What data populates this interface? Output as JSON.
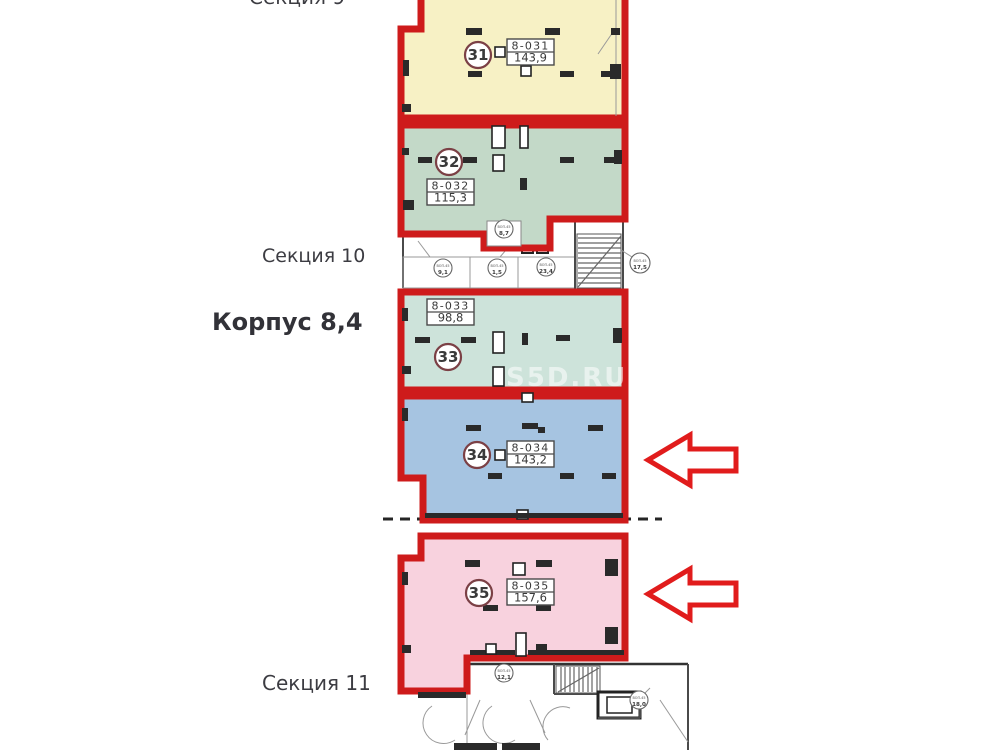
{
  "page": {
    "watermark": "S5D.RU"
  },
  "area_labels": {
    "section_9": "Секция 9",
    "section_10": "Секция 10",
    "building": "Корпус 8,4",
    "section_11": "Секция 11"
  },
  "colors": {
    "outline_red": "#ce1b1b",
    "arrow_red": "#e11c1c",
    "wall_dark": "#2a2a2a",
    "badge_border": "#7b4045"
  },
  "units": [
    {
      "number": "31",
      "code": "8-031",
      "area": "143,9",
      "fill": "#f7f1c5"
    },
    {
      "number": "32",
      "code": "8-032",
      "area": "115,3",
      "fill": "#c3d9c8"
    },
    {
      "number": "33",
      "code": "8-033",
      "area": "98,8",
      "fill": "#cde3da"
    },
    {
      "number": "34",
      "code": "8-034",
      "area": "143,2",
      "fill": "#a6c4e1"
    },
    {
      "number": "35",
      "code": "8-035",
      "area": "157,6",
      "fill": "#f8d2de"
    }
  ],
  "service_rooms": [
    {
      "code": "ВОП-45",
      "area": "8,7"
    },
    {
      "code": "ВОП-45",
      "area": "9,1"
    },
    {
      "code": "ВОП-45",
      "area": "1,5"
    },
    {
      "code": "ВОП-45",
      "area": "23,4"
    },
    {
      "code": "ВОП-45",
      "area": "17,5"
    },
    {
      "code": "ВОП-45",
      "area": "12,1"
    },
    {
      "code": "ВОП-45",
      "area": "18,0"
    }
  ]
}
